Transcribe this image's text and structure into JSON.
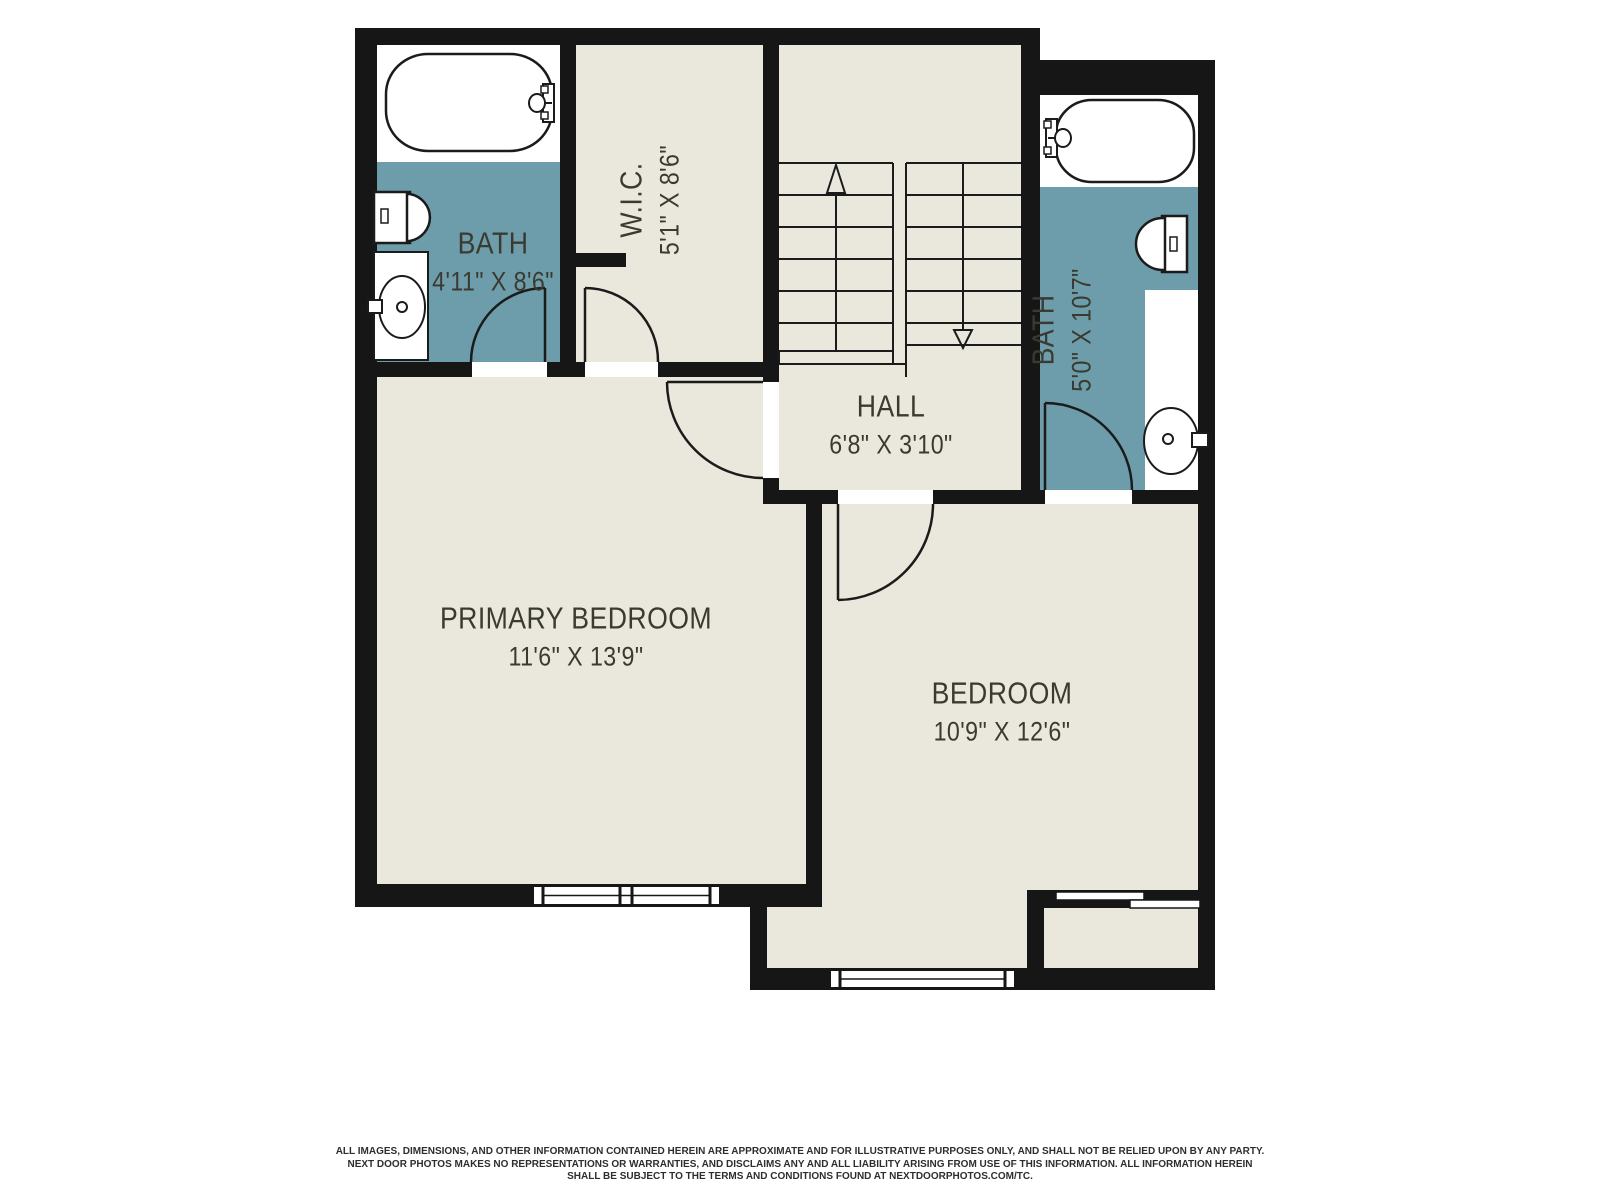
{
  "floorplan": {
    "rooms": [
      {
        "name": "bath-left",
        "label": "BATH",
        "dimensions": "4'11\" X 8'6\""
      },
      {
        "name": "walk-in-closet",
        "label": "W.I.C.",
        "dimensions": "5'1\" X 8'6\""
      },
      {
        "name": "hall",
        "label": "HALL",
        "dimensions": "6'8\" X 3'10\""
      },
      {
        "name": "bath-right",
        "label": "BATH",
        "dimensions": "5'0\" X 10'7\""
      },
      {
        "name": "primary-bedroom",
        "label": "PRIMARY BEDROOM",
        "dimensions": "11'6\" X 13'9\""
      },
      {
        "name": "bedroom",
        "label": "BEDROOM",
        "dimensions": "10'9\" X 12'6\""
      }
    ],
    "colors": {
      "floor": "#eae8dc",
      "wet_room": "#6d9dab",
      "wall": "#161616",
      "label_text": "#3b3a30",
      "fixture_fill": "#ffffff"
    },
    "fixtures": [
      "bathtub",
      "toilet",
      "sink",
      "staircase"
    ]
  },
  "disclaimer": {
    "line1": "ALL IMAGES, DIMENSIONS, AND OTHER INFORMATION CONTAINED HEREIN ARE APPROXIMATE AND FOR ILLUSTRATIVE PURPOSES ONLY, AND SHALL NOT BE RELIED UPON BY ANY PARTY.",
    "line2": "NEXT DOOR PHOTOS MAKES NO REPRESENTATIONS OR WARRANTIES, AND DISCLAIMS ANY AND ALL LIABILITY ARISING FROM USE OF THIS INFORMATION. ALL INFORMATION HEREIN",
    "line3": "SHALL BE SUBJECT TO THE TERMS AND CONDITIONS FOUND AT NEXTDOORPHOTOS.COM/TC."
  }
}
